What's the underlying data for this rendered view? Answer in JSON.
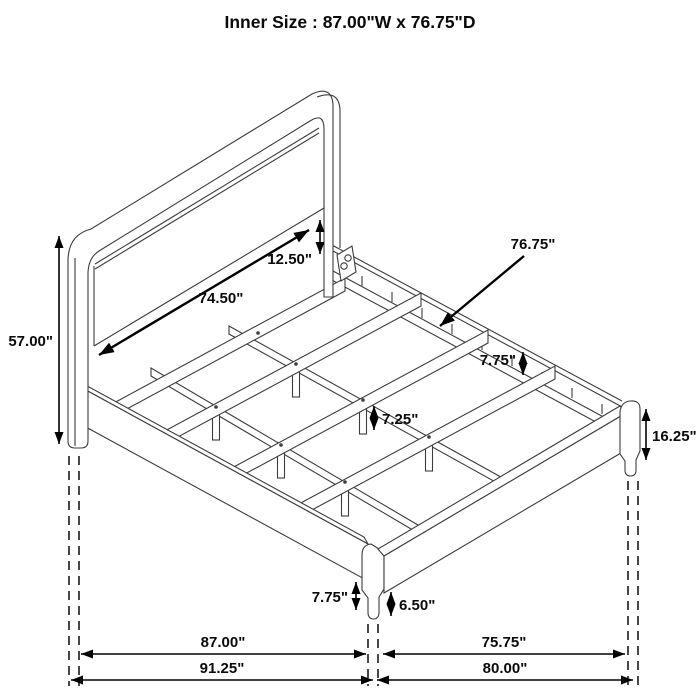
{
  "title": "Inner Size : 87.00\"W x 76.75\"D",
  "dimensions": {
    "headboard_panel_width": "74.50\"",
    "panel_to_rail_gap": "12.50\"",
    "headboard_height": "57.00\"",
    "inner_depth": "76.75\"",
    "side_rail_height": "7.75\"",
    "center_support_leg_height": "7.25\"",
    "footboard_corner_height": "16.25\"",
    "front_corner_leg_height": "7.75\"",
    "foot_leg_height": "6.50\"",
    "inner_width": "87.00\"",
    "foot_inner_span": "75.75\"",
    "overall_width": "91.25\"",
    "overall_depth": "80.00\""
  }
}
